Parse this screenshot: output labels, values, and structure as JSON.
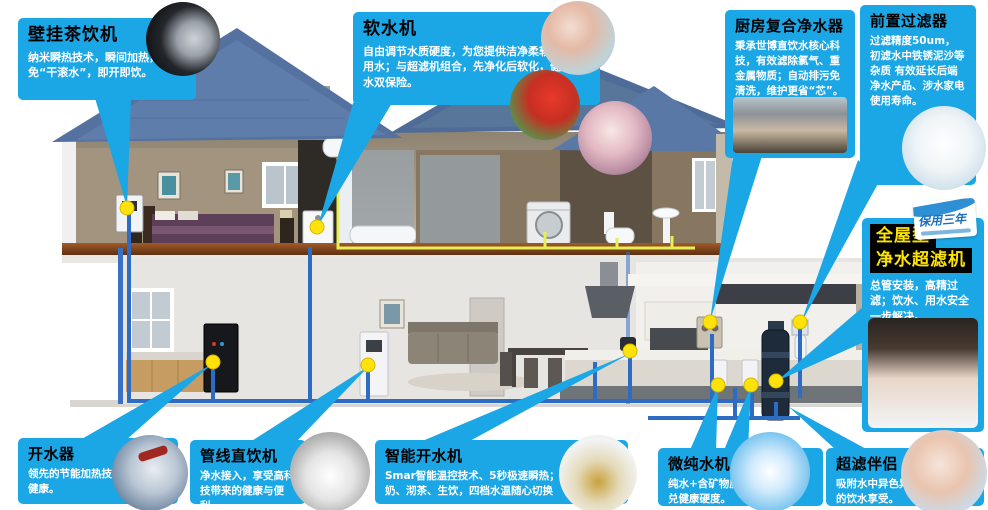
{
  "colors": {
    "callout_blue": "#1ba6e6",
    "title_black": "#000000",
    "body_white": "#ffffff",
    "highlight_yellow": "#ffe400",
    "dot_yellow": "#ffe20a",
    "pipe_blue": "#2e6cc4",
    "pipe_yellow": "#e6ef55",
    "roof_blue": "#54719f"
  },
  "callouts": [
    {
      "key": "wall_tea",
      "title": "壁挂茶饮机",
      "body": "纳米瞬热技术，瞬间加热，避免“干滚水”，即开即饮。",
      "photo": "tea-machine-closeup"
    },
    {
      "key": "softener",
      "title": "软水机",
      "body": "自由调节水质硬度，为您提供洁净柔软的生活用水；与超滤机组合，先净化后软化，健康用水双保险。",
      "photo": "shower / laundry / face-wash"
    },
    {
      "key": "kitchen_purifier",
      "title": "厨房复合净水器",
      "body": "秉承世博直饮水核心科技，有效滤除氯气、重金属物质；自动排污免清洗，维护更省“芯”。",
      "photo": "kitchen-family"
    },
    {
      "key": "prefilter",
      "title": "前置过滤器",
      "body": "过滤精度50um，初滤水中铁锈泥沙等杂质 有效延长后端净水产品、涉水家电使用寿命。",
      "photo": "filter-product"
    },
    {
      "key": "whole_house",
      "title_line1": "全屋型",
      "title_line2": "净水超滤机",
      "body": "总管安装，高精过滤；饮水、用水安全一步解决。",
      "badge": "保用三年",
      "photo": "man-drinking"
    },
    {
      "key": "boiler",
      "title": "开水器",
      "body": "领先的节能加热技术安全更添健康。",
      "photo": "faucet"
    },
    {
      "key": "pipeline",
      "title": "管线直饮机",
      "body": "净水接入，享受高科技带来的健康与便利。",
      "photo": "iced-water"
    },
    {
      "key": "smart_boiler",
      "title": "智能开水机",
      "body": "Smar智能温控技术、5秒极速瞬热；冲咖啡、牛奶、沏茶、生饮，四档水温随心切换",
      "photo": "glass-teapot"
    },
    {
      "key": "micro_pure",
      "title": "微纯水机",
      "body": "纯水+含矿物质水，双出水勾兑健康硬度。",
      "photo": "water-splash"
    },
    {
      "key": "uf_partner",
      "title": "超滤伴侣",
      "body": "吸附水中异色异味 带来沁爽的饮水享受。",
      "photo": "woman-drinking"
    }
  ]
}
